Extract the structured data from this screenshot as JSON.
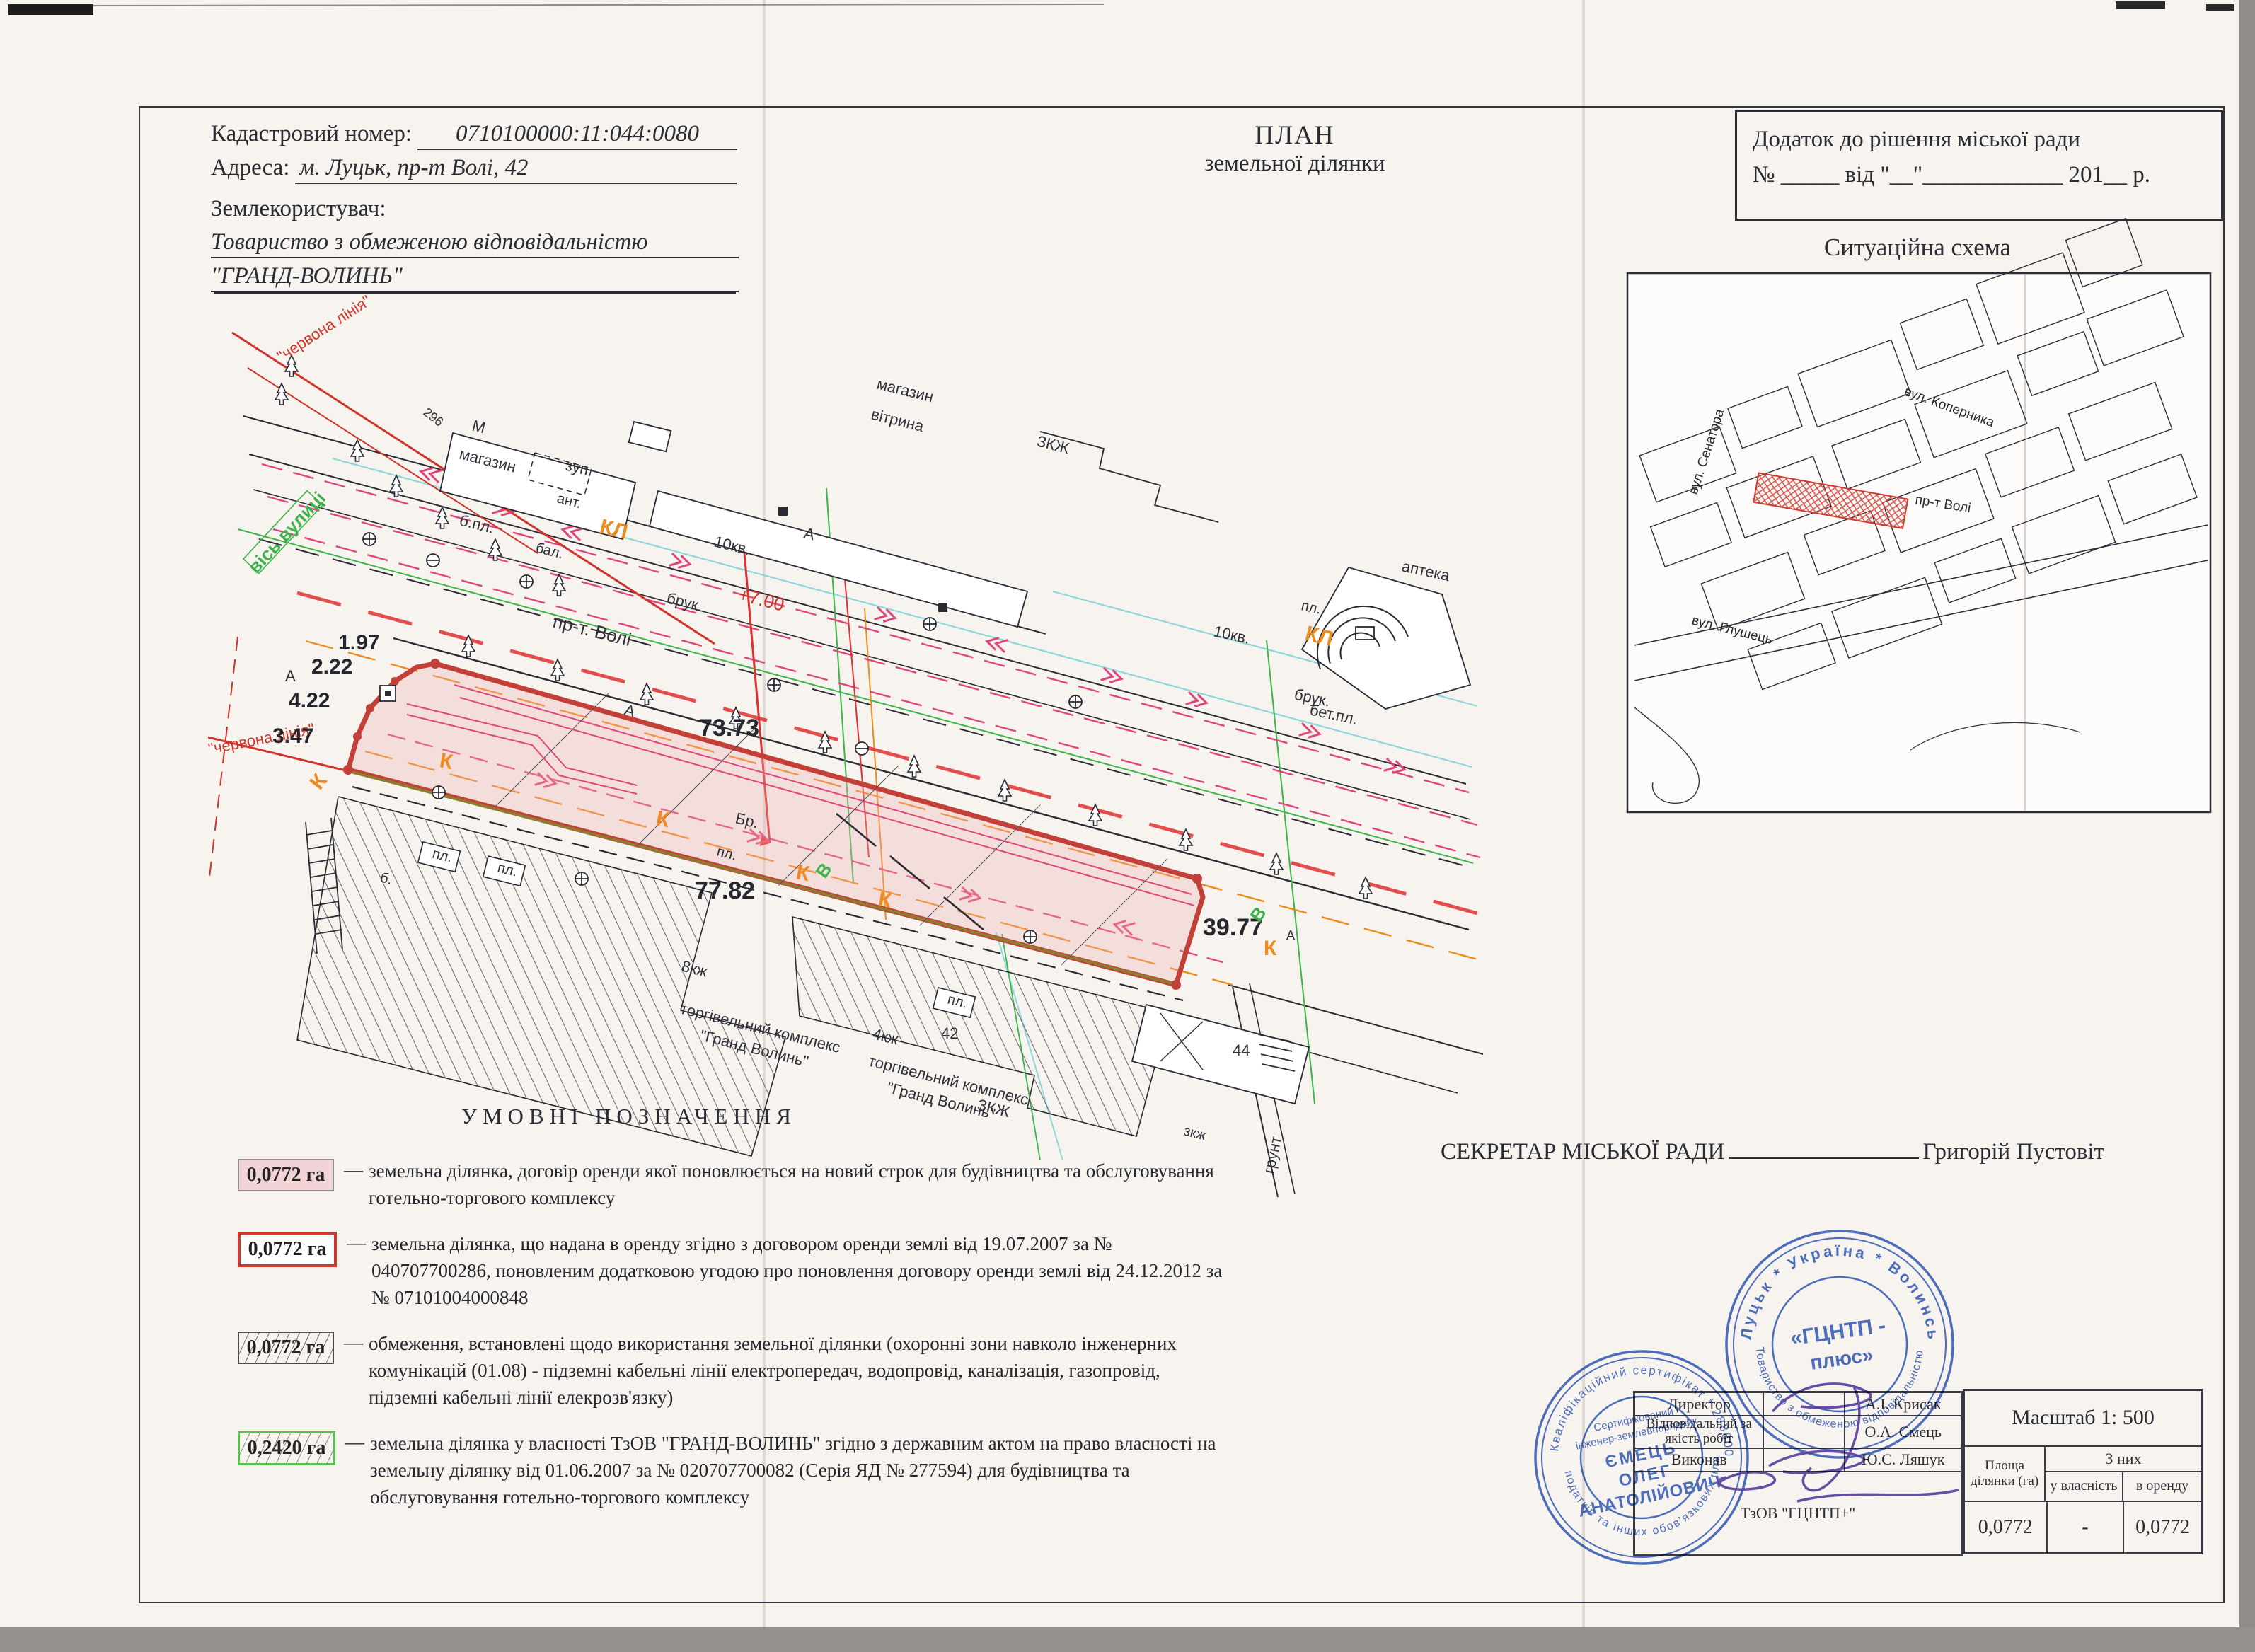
{
  "header": {
    "cadastral_label": "Кадастровий номер:",
    "cadastral_value": "0710100000:11:044:0080",
    "address_label": "Адреса:",
    "address_value": "м. Луцьк, пр-т Волі, 42",
    "landuser_label": "Землекористувач:",
    "landuser_line1": "Товариство з обмеженою відповідальністю",
    "landuser_line2": "\"ГРАНД-ВОЛИНЬ\"",
    "plan_title_line1": "ПЛАН",
    "plan_title_line2": "земельної ділянки",
    "annex_line1": "Додаток до рішення  міської ради",
    "annex_line2": "№ _____ від \"__\"____________ 201__ р."
  },
  "situation": {
    "title": "Ситуаційна схема",
    "streets": {
      "kopernika": "вул. Коперника",
      "senatora": "вул. Сенатора",
      "voli": "пр-т Волі",
      "hlushets": "вул. Глушець"
    }
  },
  "plan": {
    "labels": [
      "\"червона лінія\"",
      "\"червона лінія\"",
      "вісь вулиці",
      "б.пл.",
      "магазин",
      "вітрина",
      "М",
      "магазин",
      "зуп.",
      "296",
      "ЗКЖ",
      "ант.",
      "бал.",
      "КЛ",
      "КЛ",
      "10кв.",
      "10кв.",
      "брук.",
      "брук.",
      "пр-т. Волі",
      "+7.00",
      "А",
      "А",
      "А",
      "бет.пл.",
      "пл.",
      "аптека",
      "1.97",
      "2.22",
      "4.22",
      "3.47",
      "73.73",
      "77.82",
      "39.77",
      "Бр.",
      "пл.",
      "пл.",
      "пл.",
      "б.",
      "8кж",
      "торгівельний комплекс",
      "\"Гранд Волинь\"",
      "4кж",
      "торгівельний комплекс",
      "\"Гранд Волинь\"",
      "42",
      "44",
      "ЗКЖ",
      "зкж",
      "грунт",
      "К",
      "К",
      "К",
      "К",
      "К",
      "К",
      "А",
      "В",
      "В",
      "пл."
    ]
  },
  "legend": {
    "title": "УМОВНІ   ПОЗНАЧЕННЯ",
    "dash": "—",
    "entries": [
      {
        "area": "0,0772 га",
        "text": "земельна ділянка, договір оренди якої поновлюється на новий строк  для будівництва та обслуговування готельно-торгового комплексу"
      },
      {
        "area": "0,0772 га",
        "text": "земельна ділянка, що надана в оренду згідно з договором оренди землі від 19.07.2007 за № 040707700286, поновленим додатковою угодою про поновлення договору оренди землі від 24.12.2012 за № 07101004000848"
      },
      {
        "area": "0,0772 га",
        "text": "обмеження, встановлені щодо використання земельної ділянки (охоронні зони навколо інженерних комунікацій (01.08) - підземні кабельні лінії електропередач, водопровід, каналізація, газопровід, підземні кабельні лінії елекрозв'язку)"
      },
      {
        "area": "0,2420 га",
        "text": "земельна ділянка у власності ТзОВ \"ГРАНД-ВОЛИНЬ\" згідно з державним актом на право власності на земельну ділянку від 01.06.2007 за № 020707700082 (Серія ЯД № 277594) для будівництва та обслуговування готельно-торгового комплексу"
      }
    ]
  },
  "secretary": {
    "title": "СЕКРЕТАР МІСЬКОЇ РАДИ",
    "name": "Григорій Пустовіт"
  },
  "executors": {
    "rows": [
      {
        "role": "Директор",
        "name": "А.І. Крисак"
      },
      {
        "role": "Відповідальний за якість робіт",
        "name": "О.А. Смець"
      },
      {
        "role": "Виконав",
        "name": "Ю.С. Ляшук"
      }
    ],
    "company": "ТзОВ \"ГЦНТП+\""
  },
  "scale_table": {
    "scale": "Масштаб  1: 500",
    "col_area": "Площа ділянки (га)",
    "col_group": "З них",
    "col_own": "у власність",
    "col_rent": "в оренду",
    "val_area": "0,0772",
    "val_own": "-",
    "val_rent": "0,0772"
  },
  "stamps": {
    "small": {
      "ring_top": "Кваліфікаційний сертифікат * 2888008793 *",
      "ring_bottom": "податків та інших обов'язкових платежів",
      "inner1": "Сертифікований",
      "inner2": "інженер-землевпорядник",
      "name1": "ЄМЕЦЬ",
      "name2": "ОЛЕГ",
      "name3": "АНАТОЛІЙОВИЧ"
    },
    "big": {
      "ring_top": "Луцьк  *  Україна  *  Волинська",
      "ring_bottom": "Товариство з обмеженою відповідальністю",
      "center1": "«ГЦНТП -",
      "center2": "плюс»"
    }
  },
  "colors": {
    "parcel_stroke": "#c24038",
    "parcel_fill": "#f2d3d6",
    "red_line": "#d23329",
    "magenta": "#e0457b",
    "orange": "#ef8a1f",
    "green": "#3db44a",
    "cyan": "#8ed7da",
    "olive": "#8f7a2f",
    "stamp_blue": "#3c63c0",
    "signature_purple": "#5b3ea6"
  }
}
